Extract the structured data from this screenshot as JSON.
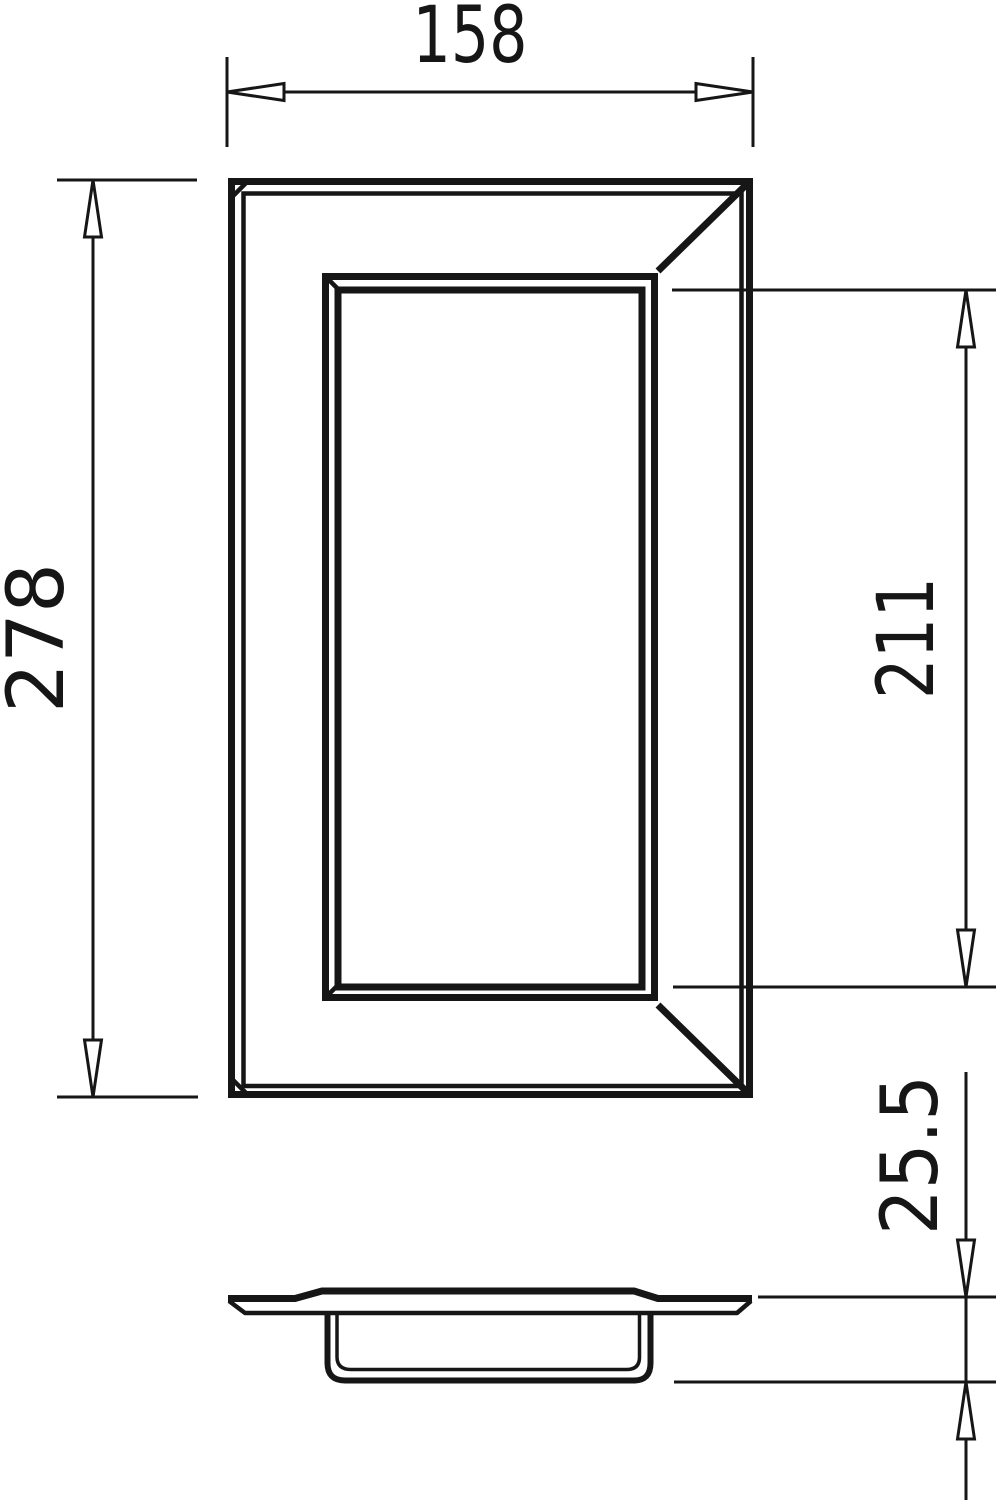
{
  "dimensions": {
    "overall_width": "158",
    "overall_height": "278",
    "inner_height": "211",
    "depth": "25.5"
  },
  "colors": {
    "line": "#161616",
    "background": "#ffffff"
  }
}
